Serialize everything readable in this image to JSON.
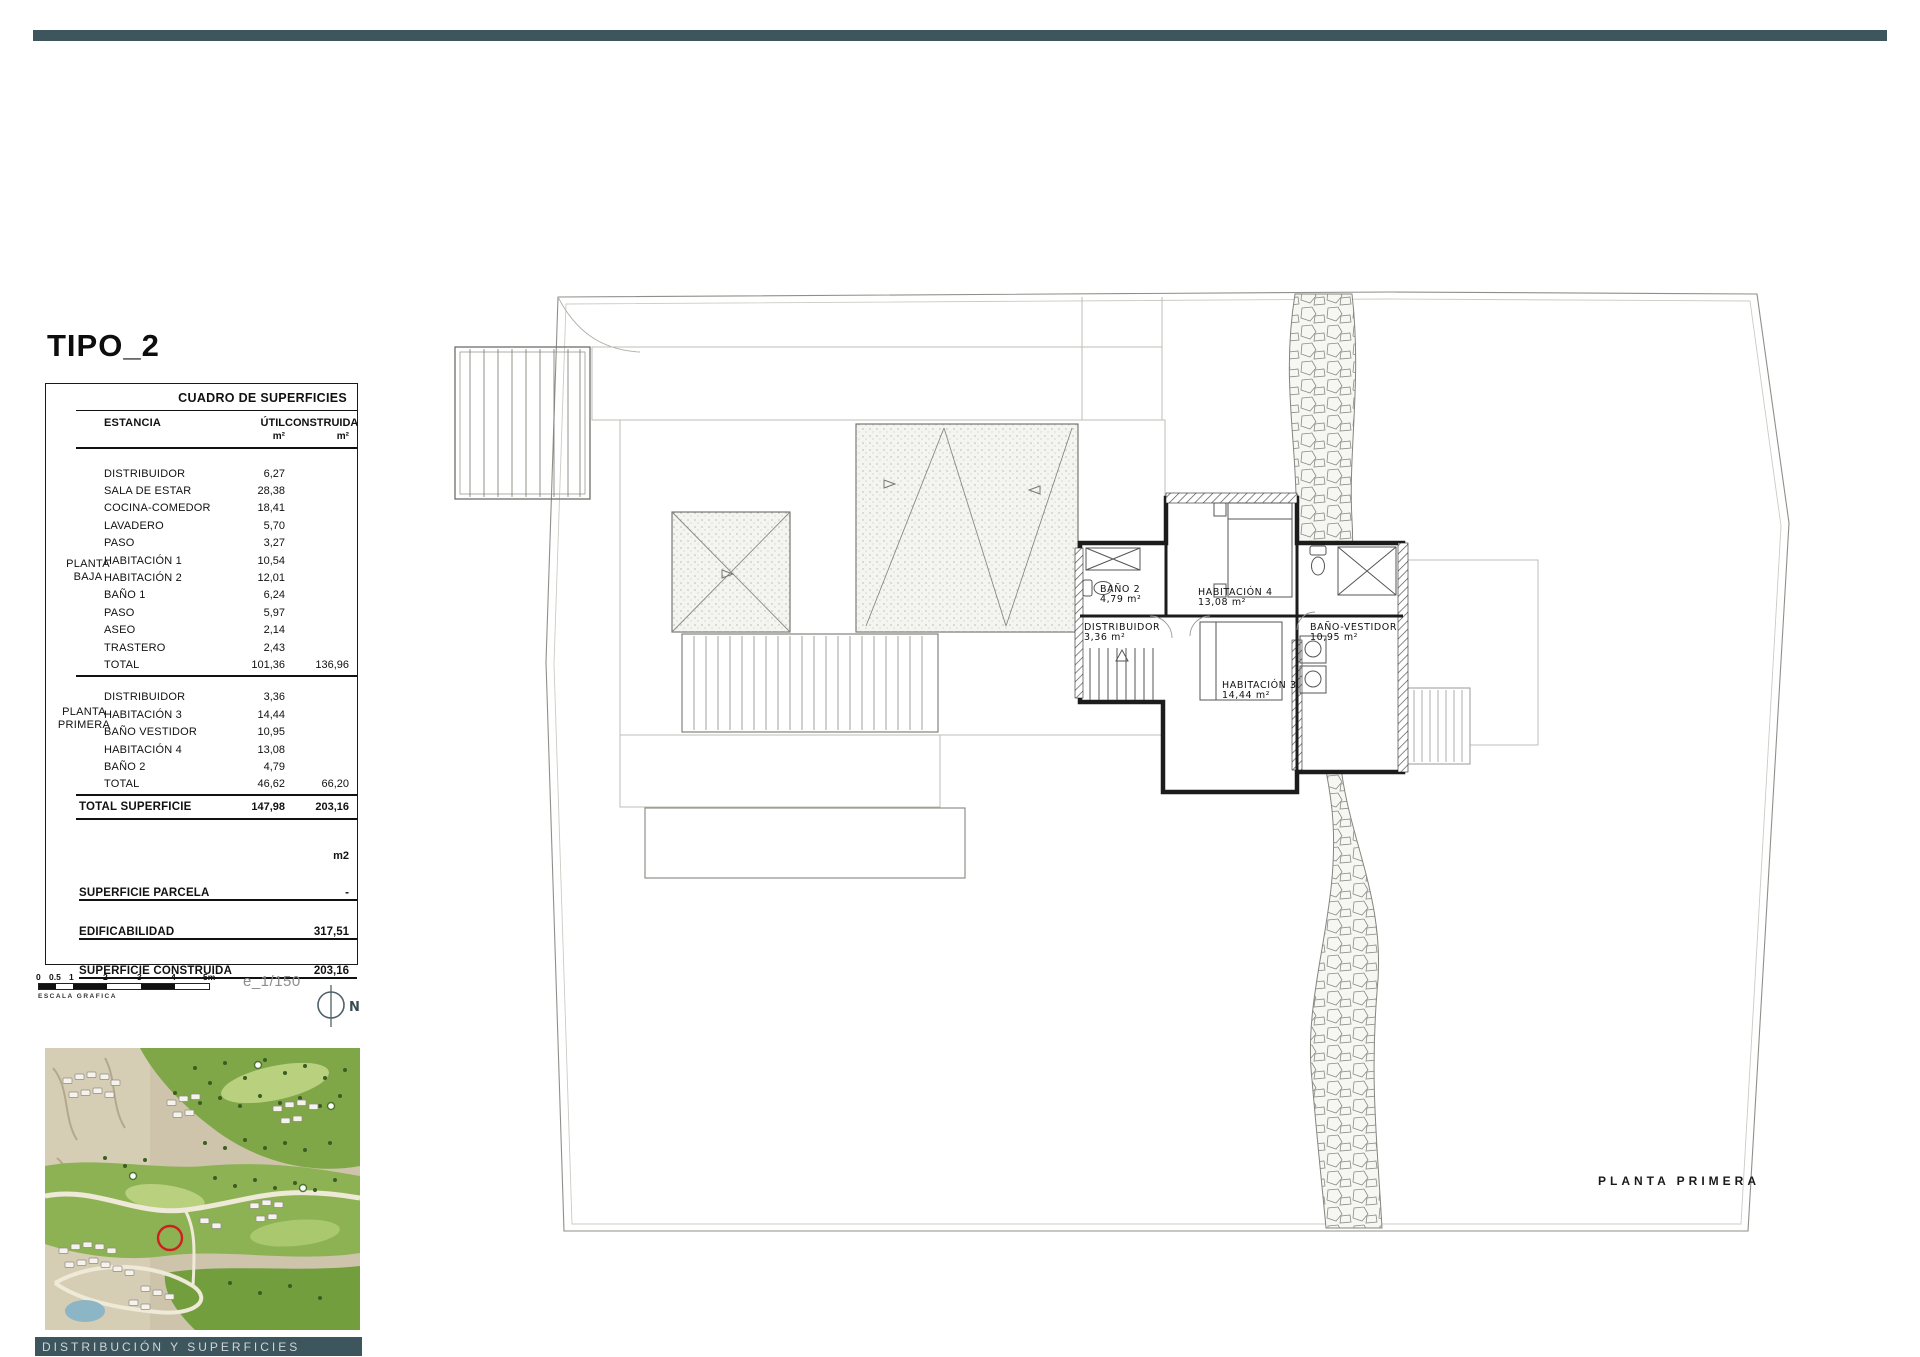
{
  "colors": {
    "bar_teal": "#3d555d",
    "marker_red": "#d01f1f"
  },
  "header": {
    "title": "TIPO_2"
  },
  "surface_table": {
    "title": "CUADRO DE SUPERFICIES",
    "columns": {
      "estancia": "ESTANCIA",
      "util": "ÚTIL",
      "construida": "CONSTRUIDA",
      "unit": "m²"
    },
    "planta_baja": {
      "label_line1": "PLANTA",
      "label_line2": "BAJA",
      "rows": [
        {
          "estancia": "DISTRIBUIDOR",
          "util": "6,27"
        },
        {
          "estancia": "SALA DE ESTAR",
          "util": "28,38"
        },
        {
          "estancia": "COCINA-COMEDOR",
          "util": "18,41"
        },
        {
          "estancia": "LAVADERO",
          "util": "5,70"
        },
        {
          "estancia": "PASO",
          "util": "3,27"
        },
        {
          "estancia": "HABITACIÓN 1",
          "util": "10,54"
        },
        {
          "estancia": "HABITACIÓN 2",
          "util": "12,01"
        },
        {
          "estancia": "BAÑO 1",
          "util": "6,24"
        },
        {
          "estancia": "PASO",
          "util": "5,97"
        },
        {
          "estancia": "ASEO",
          "util": "2,14"
        },
        {
          "estancia": "TRASTERO",
          "util": "2,43"
        }
      ],
      "total": {
        "label": "TOTAL",
        "util": "101,36",
        "construida": "136,96"
      }
    },
    "planta_primera": {
      "label_line1": "PLANTA",
      "label_line2": "PRIMERA",
      "rows": [
        {
          "estancia": "DISTRIBUIDOR",
          "util": "3,36"
        },
        {
          "estancia": "HABITACIÓN 3",
          "util": "14,44"
        },
        {
          "estancia": "BAÑO VESTIDOR",
          "util": "10,95"
        },
        {
          "estancia": "HABITACIÓN 4",
          "util": "13,08"
        },
        {
          "estancia": "BAÑO 2",
          "util": "4,79"
        }
      ],
      "total": {
        "label": "TOTAL",
        "util": "46,62",
        "construida": "66,20"
      }
    },
    "total_superficie": {
      "label": "TOTAL SUPERFICIE",
      "util": "147,98",
      "construida": "203,16"
    },
    "summary_unit": "m2",
    "summary": [
      {
        "label": "SUPERFICIE PARCELA",
        "value": "-"
      },
      {
        "label": "EDIFICABILIDAD",
        "value": "317,51"
      },
      {
        "label": "SUPERFICIE CONSTRUIDA",
        "value": "203,16"
      }
    ]
  },
  "scale": {
    "ticks": [
      "0",
      "0.5",
      "1",
      "2",
      "3",
      "4",
      "5m"
    ],
    "caption": "ESCALA GRAFICA",
    "ratio_label": "e_1/150",
    "north_label": "N"
  },
  "floor_plan": {
    "caption": "PLANTA PRIMERA",
    "rooms": {
      "bano2": {
        "name": "BAÑO 2",
        "area": "4,79 m²"
      },
      "habitacion4": {
        "name": "HABITACIÓN 4",
        "area": "13,08 m²"
      },
      "distribuidor": {
        "name": "DISTRIBUIDOR",
        "area": "3,36 m²"
      },
      "bano_vestidor": {
        "name": "BAÑO-VESTIDOR",
        "area": "10,95 m²"
      },
      "habitacion3": {
        "name": "HABITACIÓN 3",
        "area": "14,44 m²"
      }
    }
  },
  "footer": {
    "label": "DISTRIBUCIÓN Y SUPERFICIES"
  }
}
